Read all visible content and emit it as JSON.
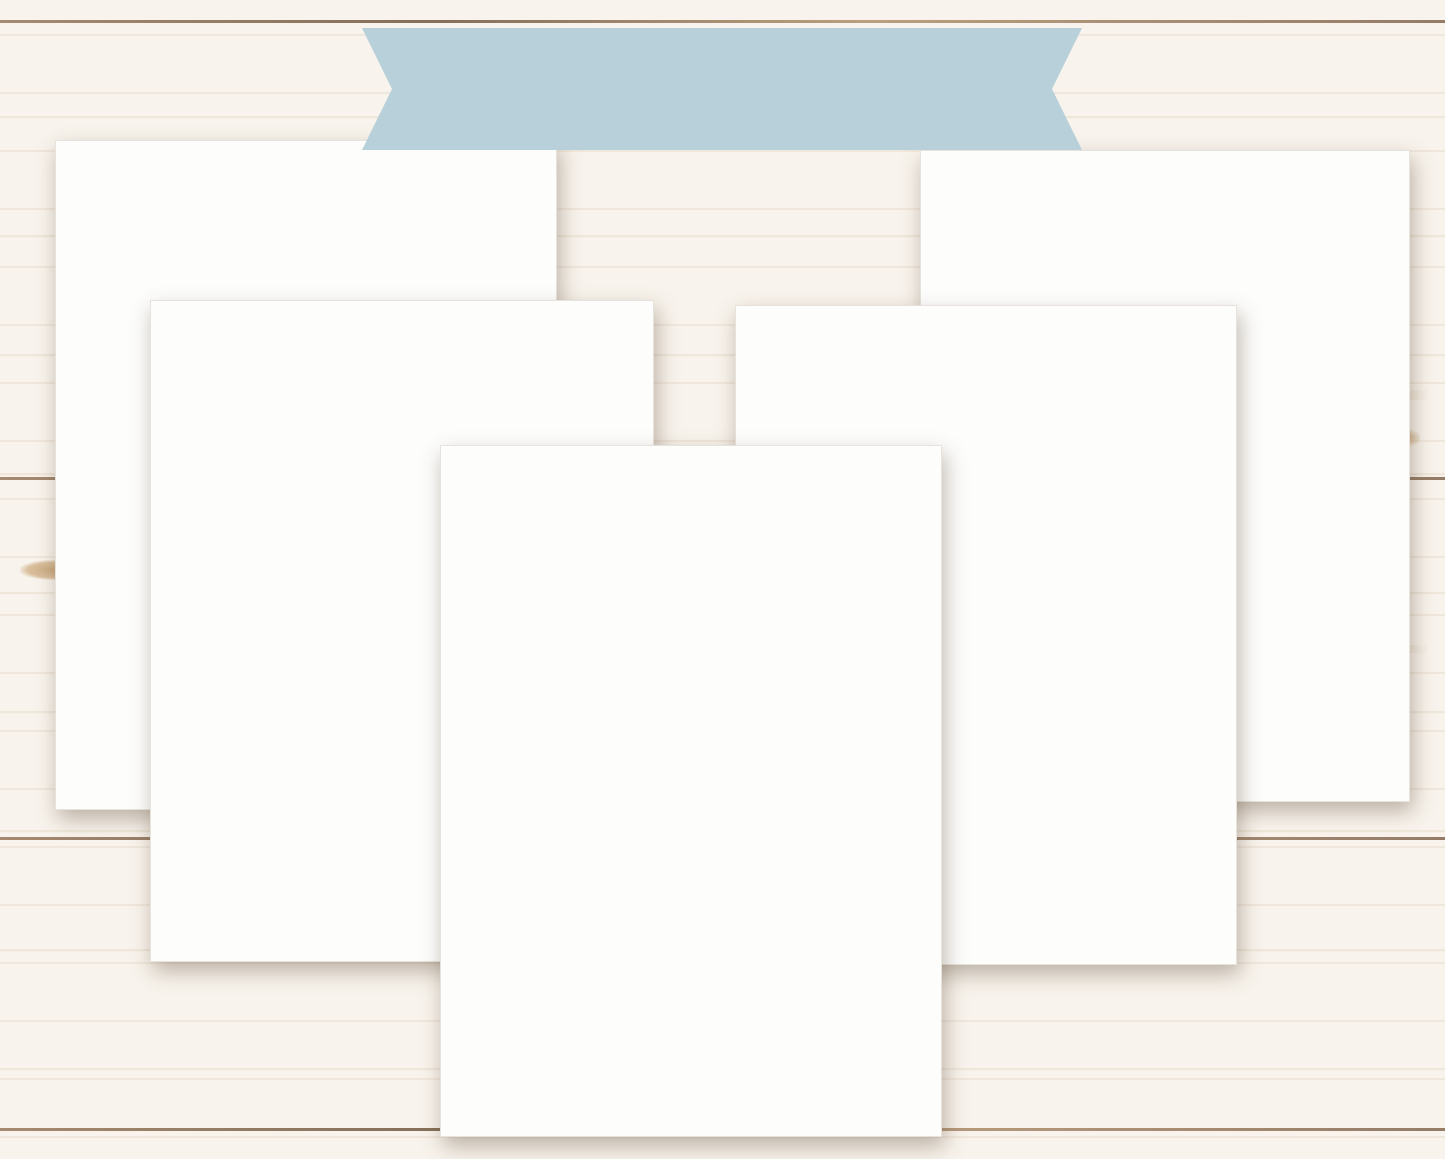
{
  "banner": {
    "label": "DATED BUNDLES",
    "bg": "#b7d0da",
    "text_color": "#4b4f55"
  },
  "brand": {
    "name": "MHP",
    "suffix": "stickers",
    "name_color": "#a9cbdc",
    "suffix_color": "#bfa077"
  },
  "palette": {
    "blue": "#64779f",
    "dkblue": "#54678c",
    "ltblue": "#b9d8f2",
    "paleblue": "#dcebf8",
    "gray": "#a9b3c3",
    "ltgray": "#dde2ea",
    "purple": "#ad85bd",
    "datepurple": "#b18cbf",
    "pink": "#eedcf2",
    "lavender": "#d9dcee",
    "green": "#93c3b2",
    "palegreen": "#e2efe9",
    "white": "#ffffff"
  },
  "sheets": {
    "time_strips": {
      "title1": "HOBONICHI COUSIN - DAILY PAGES TIME STRIPS",
      "title2": "IT'S COLD OUTSIDE-HCD2",
      "columns": 16,
      "times": [
        "6:00",
        "6:30",
        "7:00",
        "7:30",
        "8:00",
        "8:30",
        "9:00",
        "9:30",
        "10:00",
        "10:30",
        "11:00",
        "11:30",
        "12:00",
        "12:30",
        "1:00",
        "1:30",
        "2:00",
        "2:30",
        "3:00",
        "3:30",
        "4:00",
        "4:30",
        "5:00"
      ]
    },
    "daily_headers": {
      "title1": "HOBONICHI COUSIN - DAILY PAGES HEADERS",
      "title2": "IT'S COLD OUTSIDE -HCD1",
      "column1": [
        [
          "Monday",
          "blue"
        ],
        [
          "Tuesday",
          "blue"
        ],
        [
          "Wednesday",
          "blue"
        ],
        [
          "Thursday",
          "blue"
        ],
        [
          "Friday",
          "blue"
        ],
        [
          "Saturday",
          "blue"
        ],
        [
          "Sunday",
          "blue"
        ],
        [
          "Monday",
          "purple"
        ],
        [
          "Tuesday",
          "purple"
        ],
        [
          "Wednesday",
          "purple"
        ],
        [
          "Thursday",
          "purple"
        ],
        [
          "Friday",
          "purple"
        ]
      ],
      "column2": [
        [
          "Saturday",
          "purple"
        ],
        [
          "Sunday",
          "purple"
        ],
        [
          "Monday",
          "ltblue"
        ],
        [
          "Tuesday",
          "ltblue"
        ],
        [
          "Wednesday",
          "ltblue"
        ],
        [
          "Thursday",
          "ltblue"
        ],
        [
          "Friday",
          "ltblue"
        ],
        [
          "Saturday",
          "ltblue"
        ],
        [
          "Sunday",
          "ltblue"
        ],
        [
          "Monday",
          "green"
        ],
        [
          "Tuesday",
          "green"
        ],
        [
          "Wednesday",
          "green"
        ]
      ],
      "column3": [
        [
          "Thursday",
          "green"
        ],
        [
          "Friday",
          "green"
        ],
        [
          "Saturday",
          "green"
        ]
      ],
      "side_numbers": [
        "1",
        "2",
        "3",
        "4",
        "5",
        "6",
        "7",
        "8",
        "9",
        "10",
        "11",
        "12"
      ]
    },
    "weekly_extras": {
      "title1": "HOBONICHI COUSIN - WEEKLY PAGES EXTRAS",
      "title2": "IT'S COLD OUTSIDE -HCW2",
      "labels_left": [
        "TODAY I'M GRATEFUL FOR",
        "MUST DO   EVENTS   TO DO",
        "APPOINTMENTS   NOTE TO SELF",
        "DON'T FORGET",
        "NOTE TO SELF",
        "IMPORTANT"
      ],
      "labels_right": [
        "PERSONAL",
        "PROJECTS",
        "PRIORITY",
        "GOALS",
        "TO DO",
        "WORK"
      ],
      "ombre_blue": [
        "#5c7097",
        "#6e81a7",
        "#8495b7",
        "#a2b0ca",
        "#c2ccdd",
        "#e0e6ef"
      ],
      "ombre_purple": [
        "#aa7eb9",
        "#bd97c9",
        "#d4bcdc",
        "#ecdff2"
      ]
    },
    "weekly_basics": {
      "title1": "HOBONICHI COUSIN - WEEKLY PAGES BASICS",
      "title2": "IT'S COLD OUTSIDE -HCW1",
      "week_of": "week of",
      "days": [
        "MON",
        "TUE",
        "WED",
        "THU",
        "FRI",
        "SAT",
        "SUN"
      ],
      "colA_colors": [
        "blue",
        "ltblue",
        "gray"
      ],
      "colB_colors": [
        "purple",
        "green"
      ],
      "flag_colors": [
        "blue",
        "purple",
        "green"
      ],
      "bars": [
        {
          "t": "outline",
          "a": "blue",
          "b": "lavender"
        },
        {
          "t": "outline",
          "a": "purple",
          "b": "pink"
        },
        {
          "t": "outline",
          "a": "ltblue",
          "b": "white"
        },
        {
          "t": "outline",
          "a": "green",
          "b": "white"
        },
        {
          "t": "outline",
          "a": "gray",
          "b": "white"
        },
        {
          "t": "split",
          "a": "blue",
          "b": "ltgray"
        },
        {
          "t": "split",
          "a": "purple",
          "b": "pink"
        },
        {
          "t": "split",
          "a": "ltblue",
          "b": "white"
        },
        {
          "t": "split",
          "a": "gray",
          "b": "white"
        },
        {
          "t": "split",
          "a": "purple",
          "b": "pink"
        },
        {
          "t": "split",
          "a": "dkblue",
          "b": "ltgray"
        },
        {
          "t": "split",
          "a": "purple",
          "b": "lavender"
        },
        {
          "t": "solid",
          "a": "ltblue",
          "b": "ltblue"
        },
        {
          "t": "solid",
          "a": "green",
          "b": "green"
        },
        {
          "t": "outline",
          "a": "blue",
          "b": "lavender"
        },
        {
          "t": "outline",
          "a": "purple",
          "b": "pink"
        },
        {
          "t": "dashed",
          "a": "ltblue",
          "b": "white"
        },
        {
          "t": "dashed",
          "a": "green",
          "b": "white"
        },
        {
          "t": "dashed",
          "a": "gray",
          "b": "white"
        }
      ]
    },
    "monthly": {
      "title1": "HOBONICHI COUSIN - DATED MONTHLY CALENDAR",
      "title2": "IT'S COLD OUTSIDE-HCM1A",
      "month": "Jan",
      "script_big": [
        "this month",
        "to do"
      ],
      "script_row1": [
        "birthday",
        "payday",
        "meeting",
        "sick day"
      ],
      "script_row2": [
        "no school",
        "bill due",
        "carpool",
        "day off"
      ],
      "weekdays": [
        "MONDAY",
        "TUESDAY",
        "WEDNESDAY",
        "THURSDAY",
        "FRIDAY",
        "SATURDAY",
        "SUNDAY"
      ],
      "holidays": [
        "NEW YEAR'S DAY",
        "MARTIN LUTHER KING JR DAY"
      ],
      "dates": [
        "1",
        "2",
        "3",
        "4",
        "5",
        "6",
        "7",
        "8",
        "9",
        "10",
        "11",
        "12",
        "13",
        "14",
        "15",
        "16",
        "17",
        "18",
        "19",
        "20",
        "21",
        "22",
        "23",
        "24",
        "25",
        "26",
        "27",
        "28",
        "29",
        "30",
        "31"
      ],
      "blank_cells": 4,
      "icons": [
        "comb-scissors",
        "dumbbells",
        "sneakers",
        "piggy-bank",
        "washing-machine",
        "trash-can",
        "tooth",
        "luggage",
        "medicine",
        "notebook",
        "gas-pump",
        "shopping-cart",
        "scale",
        "gift",
        "stethoscope"
      ]
    }
  }
}
